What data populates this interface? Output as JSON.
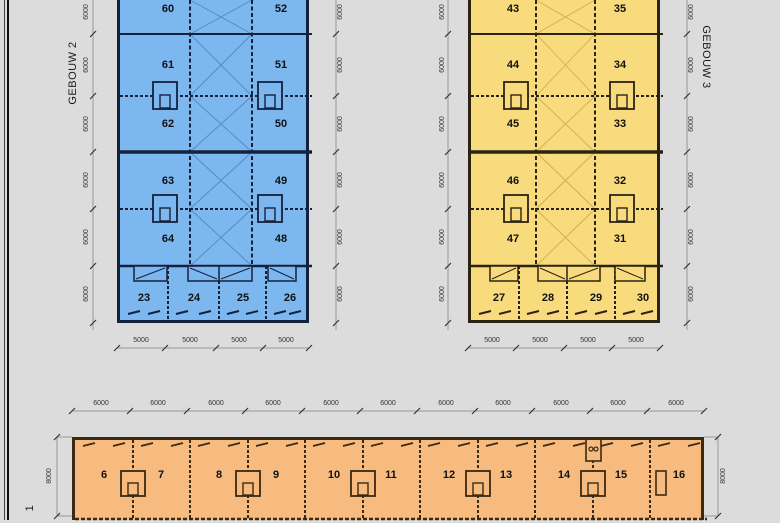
{
  "colors": {
    "background": "#dcdcdc",
    "gebouw2_fill": "#7db7f0",
    "gebouw3_fill": "#f8db7d",
    "gebouw1_fill": "#f7bb80"
  },
  "buildings": {
    "gebouw2": {
      "name": "GEBOUW 2",
      "units_left": [
        "60",
        "61",
        "62",
        "63",
        "64"
      ],
      "units_right": [
        "52",
        "51",
        "50",
        "49",
        "48"
      ],
      "units_front": [
        "23",
        "24",
        "25",
        "26"
      ]
    },
    "gebouw3": {
      "name": "GEBOUW 3",
      "units_left": [
        "43",
        "44",
        "45",
        "46",
        "47"
      ],
      "units_right": [
        "35",
        "34",
        "33",
        "32",
        "31"
      ],
      "units_front": [
        "27",
        "28",
        "29",
        "30"
      ]
    },
    "gebouw1": {
      "name_visible": "1",
      "units": [
        "6",
        "7",
        "8",
        "9",
        "10",
        "11",
        "12",
        "13",
        "14",
        "15",
        "16"
      ]
    }
  },
  "dimensions": {
    "bay_depth_labels": [
      "6000",
      "6000",
      "6000",
      "6000",
      "6000",
      "6000"
    ],
    "front_unit_width_labels": [
      "5000",
      "5000",
      "5000",
      "5000"
    ],
    "g1_bay_width_labels": [
      "6000",
      "6000",
      "6000",
      "6000",
      "6000",
      "6000",
      "6000",
      "6000",
      "6000",
      "6000",
      "6000"
    ],
    "g1_depth_labels": [
      "8000",
      "8000"
    ]
  }
}
